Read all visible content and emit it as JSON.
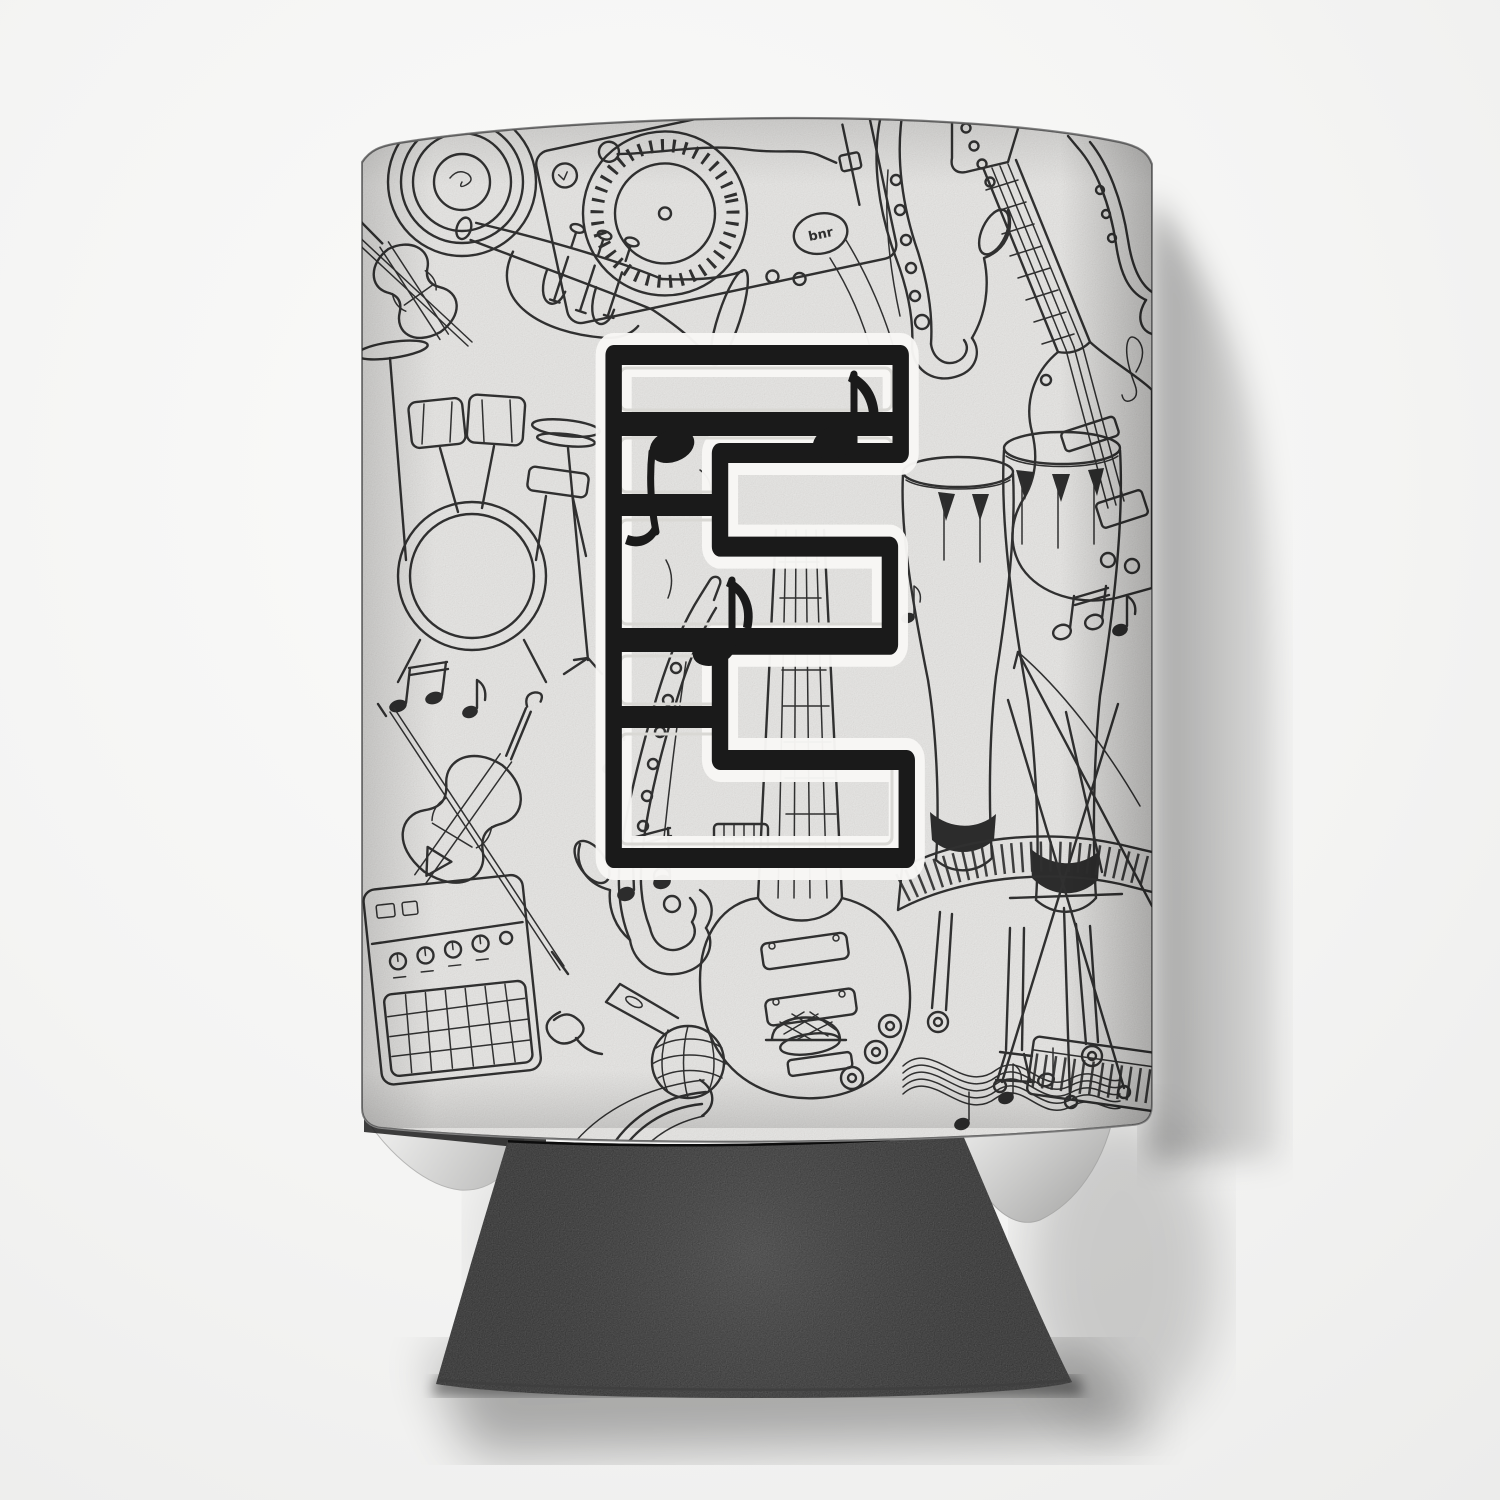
{
  "scene": {
    "type": "product-photo",
    "description": "Beverage can cooler sleeve printed with black and white hand-drawn music doodles and a large applique monogram letter, standing upright on a white surface with a soft cast shadow to the right and a black folded base below",
    "background_color": "#f4f4f3",
    "cast_shadow_color": "#a9a9a9"
  },
  "product": {
    "name": "music note monogram can cooler",
    "monogram_letter": "E",
    "turntable_label": "bnr",
    "fabric_color": "#f1f0ee",
    "doodle_ink_color": "#303030",
    "monogram_color": "#1a1a1a",
    "monogram_halo_color": "#f8f7f5",
    "base_color": "#212121",
    "motifs": [
      "vinyl-record",
      "dj-turntable",
      "trumpet",
      "violin",
      "drum-kit",
      "saxophone",
      "bass-guitar",
      "electric-guitar",
      "guitar-amplifier",
      "microphone",
      "conga-drums",
      "grand-piano",
      "keyboard",
      "music-staff-ribbon",
      "music-notes",
      "treble-clef"
    ]
  }
}
